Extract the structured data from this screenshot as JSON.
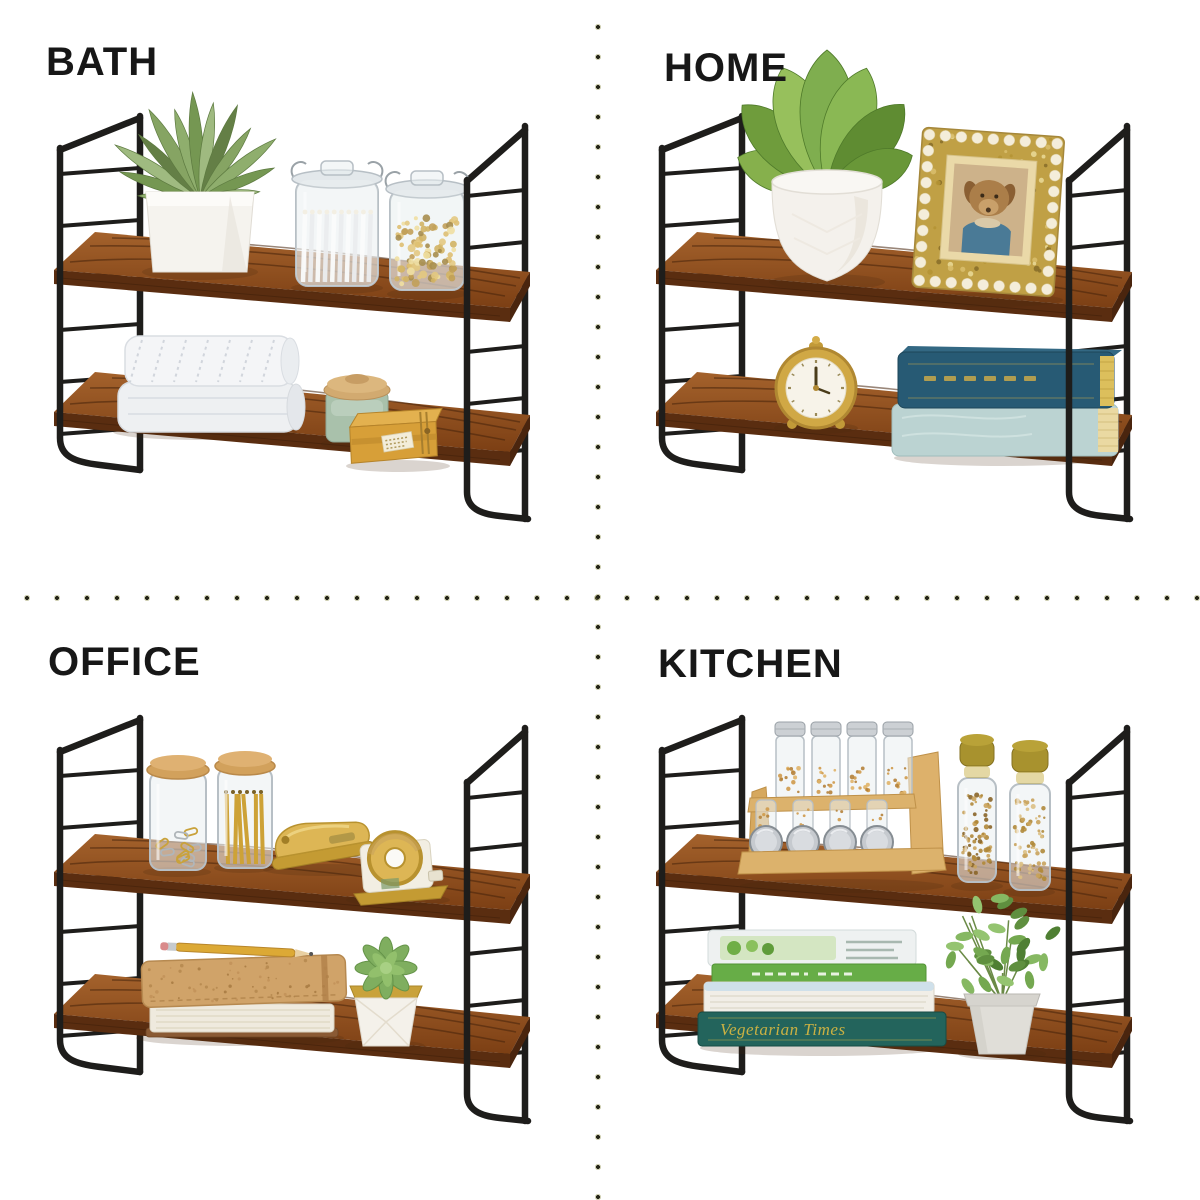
{
  "page": {
    "background": "#ffffff",
    "type": "product-style-collage"
  },
  "divider": {
    "dot_core_color": "#26261a",
    "dot_halo_color": "#9a9a5a"
  },
  "label_color": "#171717",
  "frame_colors": {
    "metal": "#1e1d1b",
    "wood_top_light": "#a4622c",
    "wood_top_dark": "#7c3f14",
    "wood_front": "#5a2d10",
    "wood_grain": "#46220b"
  },
  "sections": [
    {
      "id": "bath",
      "label": "BATH",
      "items_top": [
        "faux succulent in white cube pot",
        "glass clamp jar with cotton swabs",
        "glass clamp jar with gold bath beads"
      ],
      "items_bottom": [
        "stack of folded white towels",
        "green candle jar with wood lid",
        "mustard soap box"
      ]
    },
    {
      "id": "home",
      "label": "HOME",
      "items_top": [
        "faux plant in round white pot",
        "ornate gold mosaic picture frame with dog photo"
      ],
      "items_bottom": [
        "gold alarm clock",
        "two stacked hardcover books"
      ]
    },
    {
      "id": "office",
      "label": "OFFICE",
      "items_top": [
        "glass jar of paper clips",
        "glass jar of gold pencils",
        "gold stapler",
        "gold tape dispenser"
      ],
      "items_bottom": [
        "cork notebook stack with pencil",
        "succulent in faceted white pot"
      ]
    },
    {
      "id": "kitchen",
      "label": "KITCHEN",
      "book_spine_text": "Vegetarian Times",
      "items_top": [
        "bamboo spice rack with spice jars",
        "two tall glass spice bottles"
      ],
      "items_bottom": [
        "stack of cookbooks",
        "potted herb plant in gray pot"
      ]
    }
  ]
}
